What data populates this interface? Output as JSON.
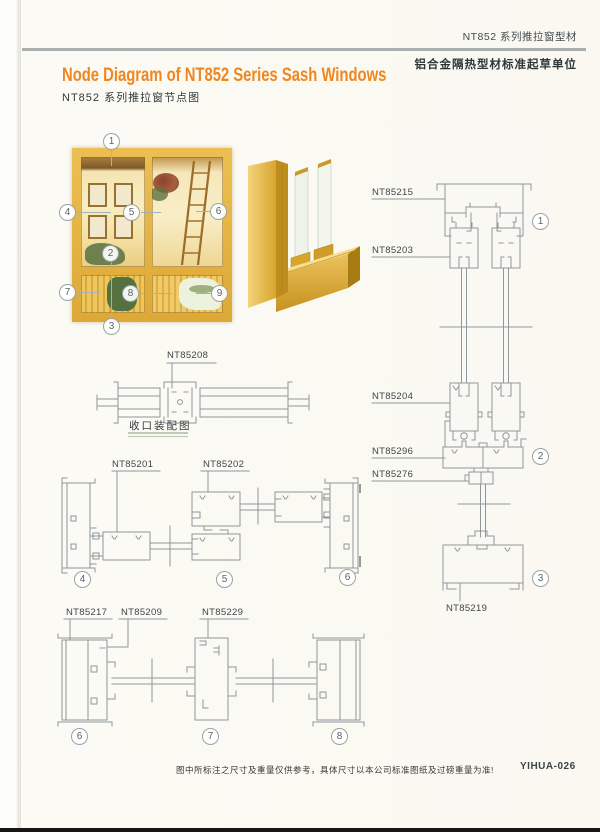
{
  "header": {
    "series": "NT852 系列推拉窗型材",
    "organization": "铝合金隔热型材标准起草单位"
  },
  "title": {
    "en": "Node Diagram of NT852 Series Sash Windows",
    "cn": "NT852 系列推拉窗节点图"
  },
  "photo": {
    "callouts": [
      "1",
      "2",
      "3",
      "4",
      "5",
      "6",
      "7",
      "8",
      "9"
    ]
  },
  "diagrams": {
    "closing_assembly": {
      "part": "NT85208",
      "caption": "收口装配图"
    },
    "vertical_section": {
      "parts": {
        "head_frame": "NT85215",
        "sash_top": "NT85203",
        "sash_bottom": "NT85204",
        "bottom_track": "NT85296",
        "adapter": "NT85276",
        "sill": "NT85219"
      },
      "callouts": [
        "1",
        "2",
        "3"
      ]
    },
    "horizontal_mid": {
      "parts": {
        "frame_jamb": "NT85201",
        "meeting_stile": "NT85202"
      },
      "callouts": [
        "4",
        "5",
        "6"
      ]
    },
    "horizontal_bottom": {
      "parts": {
        "jamb": "NT85217",
        "glazing_adapter": "NT85209",
        "meeting_stile": "NT85229"
      },
      "callouts": [
        "6",
        "7",
        "8"
      ]
    }
  },
  "footer": {
    "note": "图中所标注之尺寸及重量仅供参考，具体尺寸以本公司标准图纸及过磅重量为准!",
    "code": "YIHUA-026"
  },
  "colors": {
    "accent_orange": "#f0861f",
    "diagram_line": "#8e989b",
    "profile_gold": "#e2ac38"
  }
}
